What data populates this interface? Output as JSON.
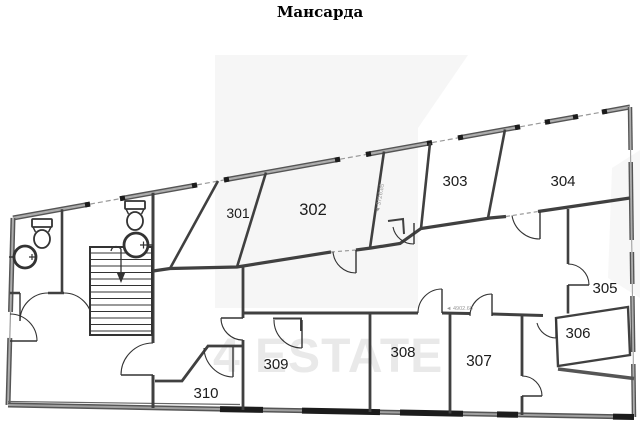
{
  "title": "Мансарда",
  "watermark": "4 ESTATE",
  "rooms": [
    {
      "number": "301"
    },
    {
      "number": "302"
    },
    {
      "number": "303"
    },
    {
      "number": "304"
    },
    {
      "number": "305"
    },
    {
      "number": "306"
    },
    {
      "number": "307"
    },
    {
      "number": "308"
    },
    {
      "number": "309"
    },
    {
      "number": "310"
    }
  ],
  "dimensions": {
    "room302_wall": "◄ 3726.85",
    "room307_wall": "◄ 4902.60"
  },
  "colors": {
    "outer_wall_dark": "#555555",
    "outer_wall_fill": "#adadad",
    "interior_wall": "#404040",
    "door_arc": "#333333",
    "watermark_gray": "#e9e9e9",
    "pale_shape": "#f6f6f6",
    "window_dash": "#999999"
  }
}
